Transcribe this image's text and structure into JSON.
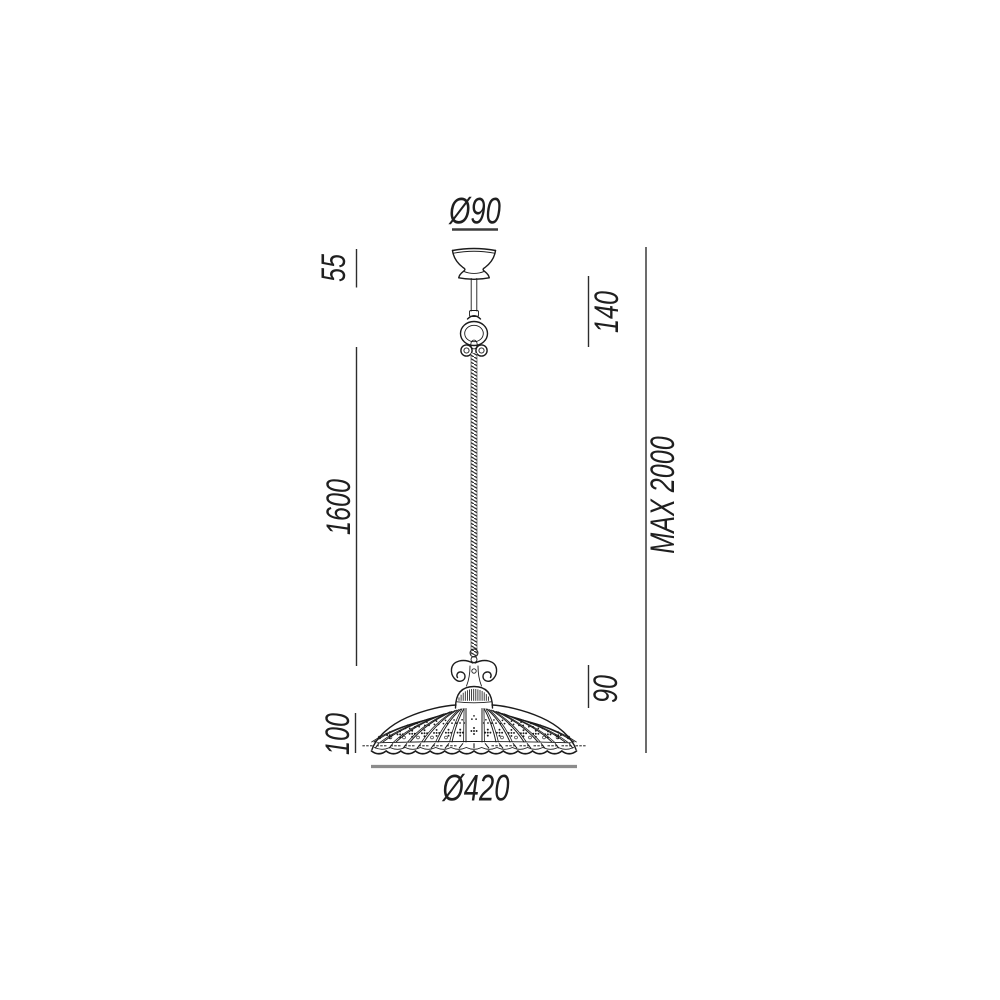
{
  "drawing": {
    "type": "technical-dimension-drawing",
    "subject": "pendant ceiling lamp",
    "labels": {
      "canopy_diameter": "Ø90",
      "canopy_height": "55",
      "suspension_upper": "140",
      "cable_length": "1600",
      "max_height": "MAX 2000",
      "shade_fitting_height": "90",
      "shade_height": "100",
      "shade_diameter": "Ø420"
    },
    "colors": {
      "line": "#1c1c1c",
      "dim_line": "#2d2d2d",
      "text": "#1f1f1f",
      "diameter_line_top": "#3c3c3c",
      "diameter_line_bottom": "#8c8c8c"
    }
  }
}
